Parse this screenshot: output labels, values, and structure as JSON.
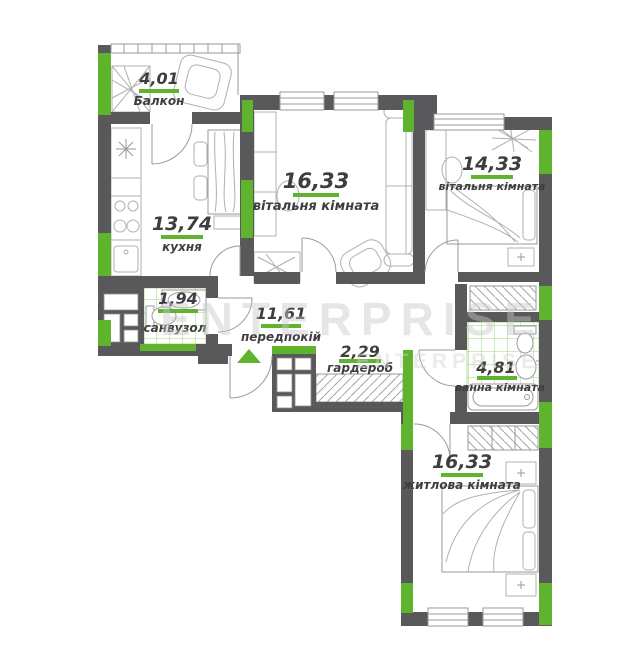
{
  "plan": {
    "watermark": "ENTERPRISE",
    "rooms": [
      {
        "id": "balcony",
        "name": "Балкон",
        "area": "4,01"
      },
      {
        "id": "kitchen",
        "name": "кухня",
        "area": "13,74"
      },
      {
        "id": "living-room",
        "name": "вітальня кімната",
        "area": "16,33"
      },
      {
        "id": "living-room-2",
        "name": "вітальня кімната",
        "area": "14,33"
      },
      {
        "id": "wc",
        "name": "санвузол",
        "area": "1,94"
      },
      {
        "id": "hallway",
        "name": "передпокій",
        "area": "11,61"
      },
      {
        "id": "wardrobe",
        "name": "гардероб",
        "area": "2,29"
      },
      {
        "id": "bathroom",
        "name": "ванна кімната",
        "area": "4,81"
      },
      {
        "id": "bedroom",
        "name": "житлова кімната",
        "area": "16,33"
      }
    ],
    "colors": {
      "wall": "#59595b",
      "accent": "#5fb32d",
      "tile": "#7cc653",
      "furniture": "#b0b0b2",
      "text": "#3e3e40"
    }
  }
}
